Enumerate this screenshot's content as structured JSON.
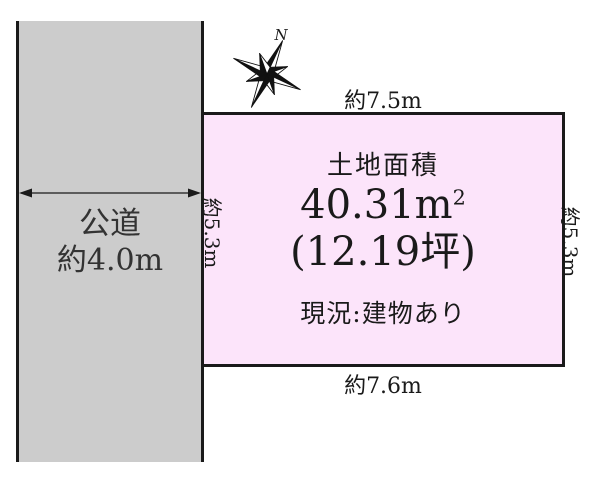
{
  "compass": {
    "north": "N"
  },
  "road": {
    "name": "公道",
    "width_label": "約4.0m"
  },
  "plot": {
    "title": "土地面積",
    "area_main": "40.31m",
    "area_exponent": "2",
    "area_tsubo": "(12.19坪)",
    "status": "現況:建物あり"
  },
  "dimensions": {
    "top": "約7.5m",
    "bottom": "約7.6m",
    "left": "約5.3m",
    "right": "約5.3m"
  },
  "colors": {
    "road_fill": "#cccccc",
    "plot_fill": "#fce4fa",
    "line": "#1a1a1a"
  }
}
